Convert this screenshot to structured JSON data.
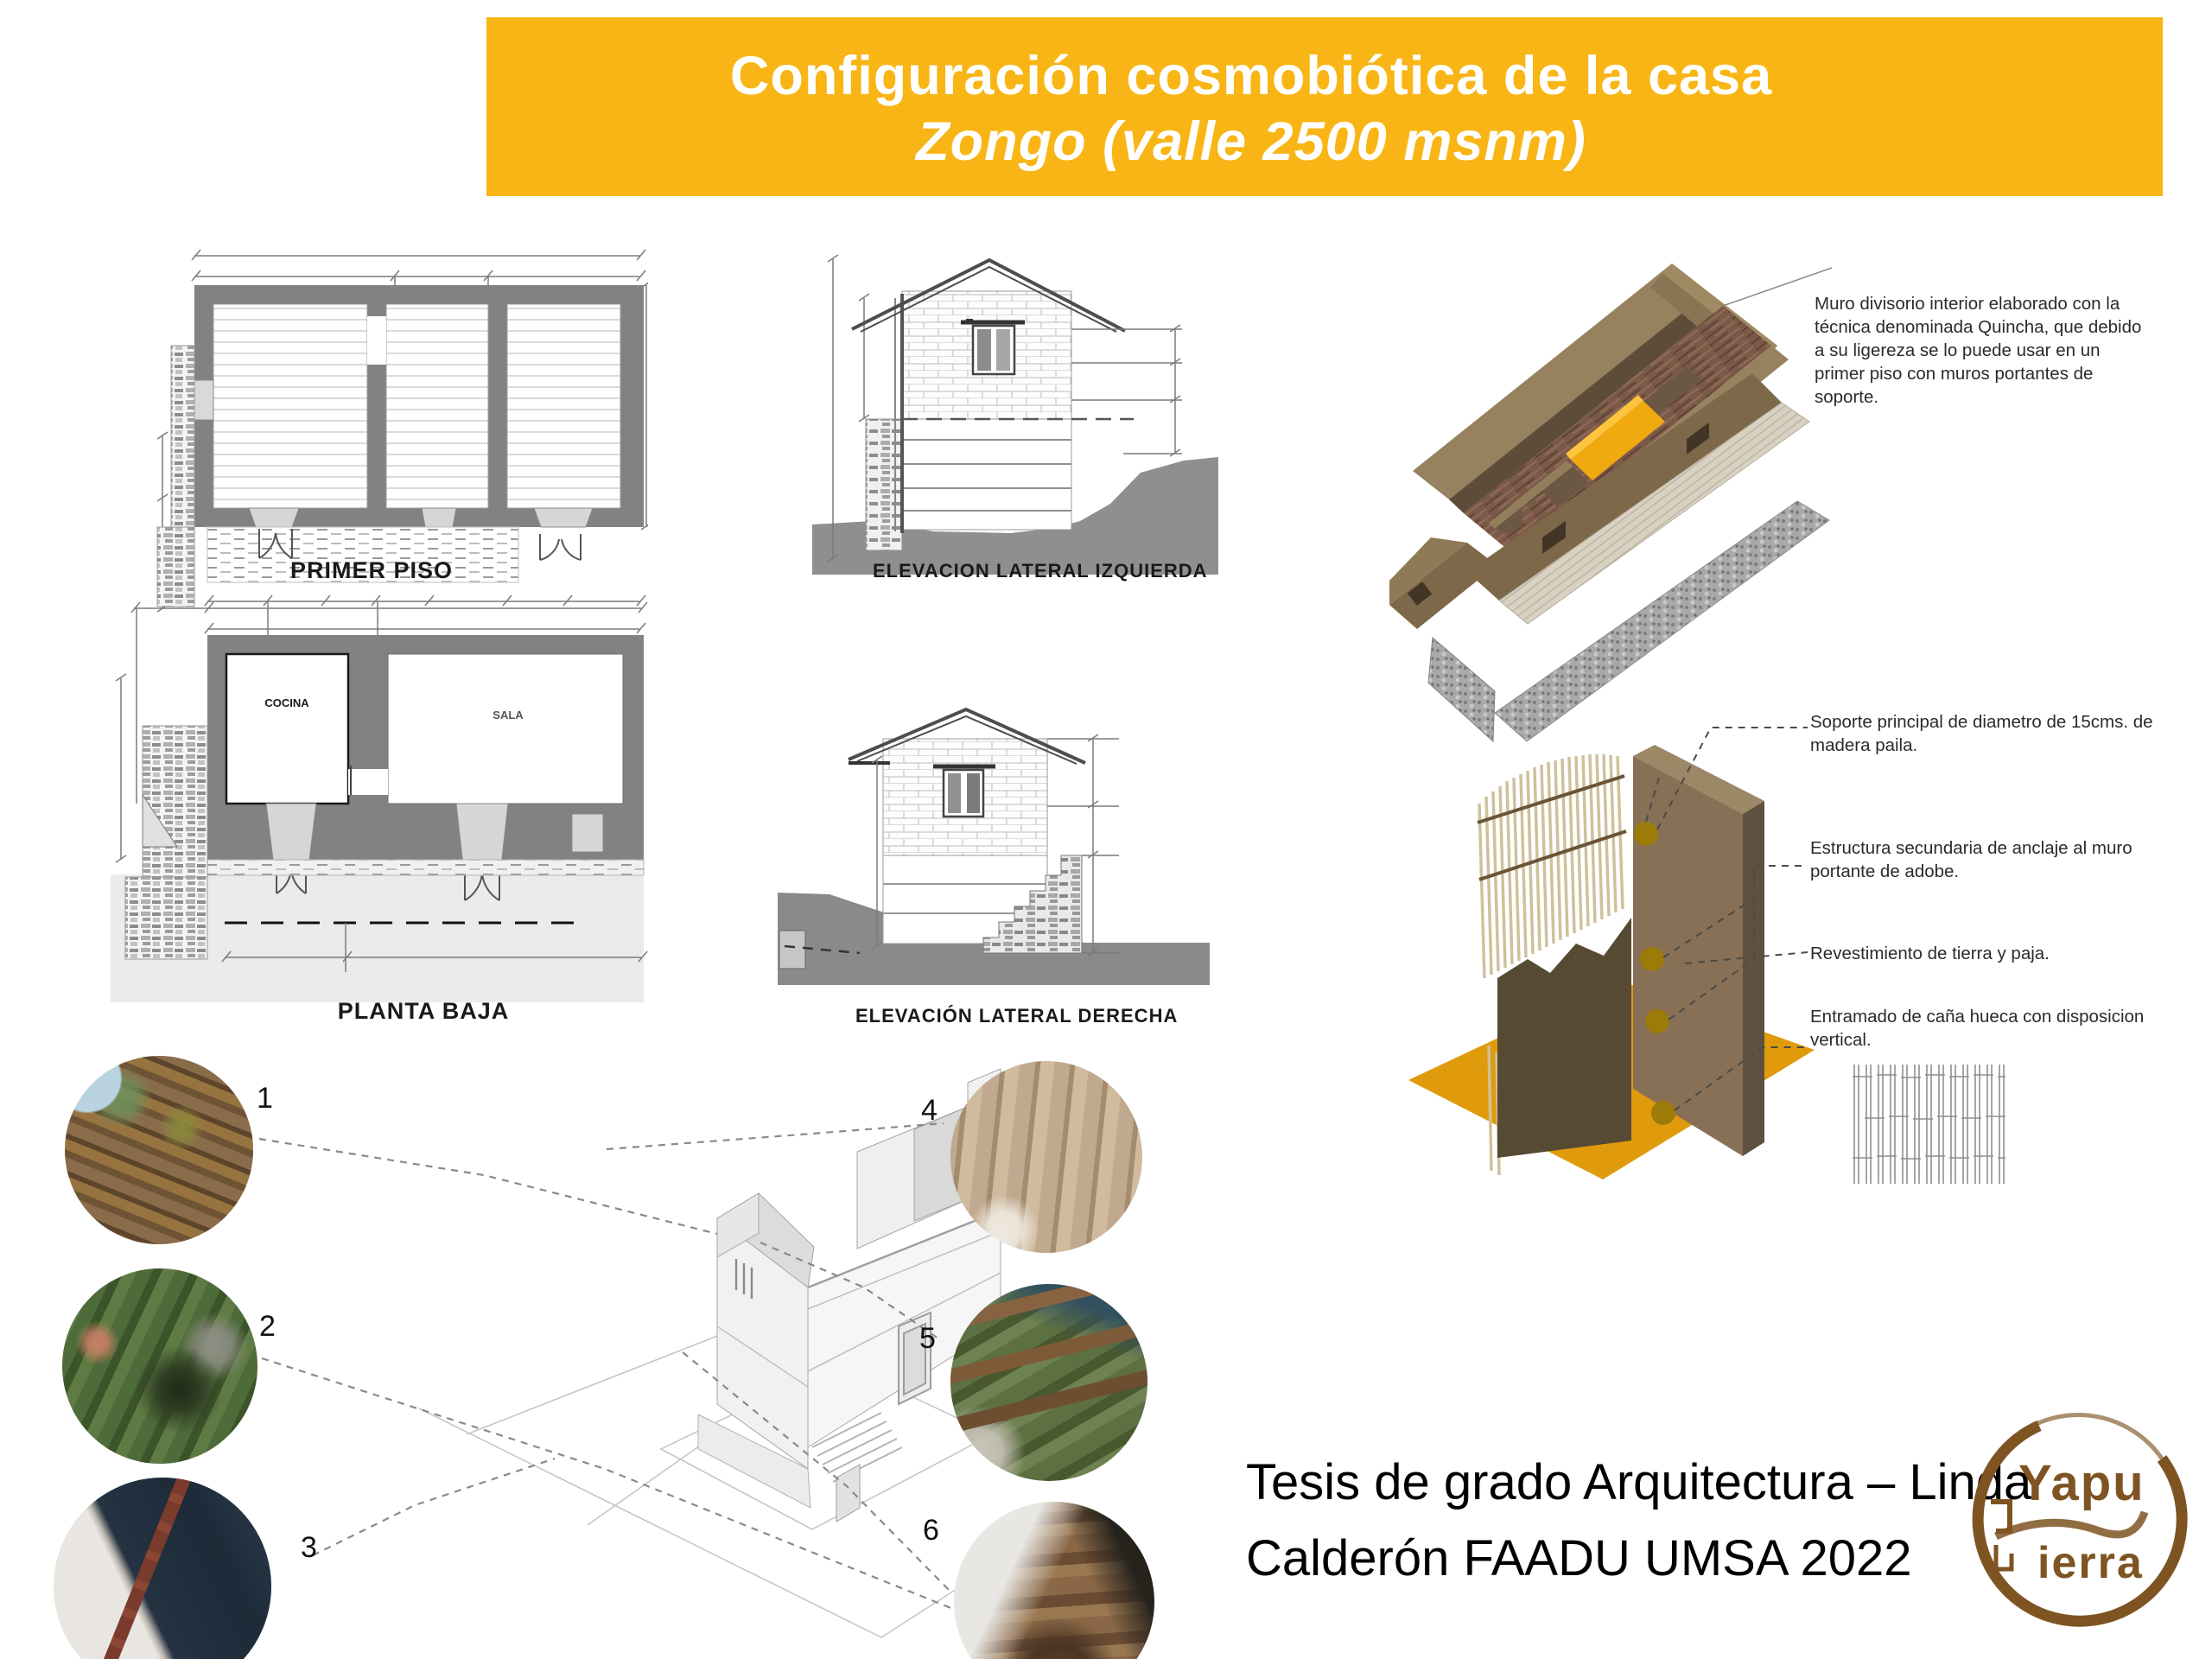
{
  "title": {
    "line1": "Configuración cosmobiótica de la casa",
    "line2": "Zongo (valle 2500 msnm)"
  },
  "drawings": {
    "primer_piso": "PRIMER PISO",
    "planta_baja": "PLANTA BAJA",
    "cocina": "COCINA",
    "sala": "SALA",
    "elev_izq": "ELEVACION LATERAL IZQUIERDA",
    "elev_der": "ELEVACIÓN LATERAL DERECHA"
  },
  "annotations": {
    "quincha": "Muro divisorio interior elaborado con la técnica denominada Quincha, que debido a su ligereza se lo puede usar en un primer piso con muros portantes de soporte.",
    "soporte": "Soporte principal de diametro de 15cms. de madera paila.",
    "estructura": "Estructura secundaria de anclaje al muro portante de adobe.",
    "revestimiento": "Revestimiento de tierra y paja.",
    "entramado": "Entramado de caña hueca con disposicion vertical."
  },
  "photos": [
    {
      "number": "1"
    },
    {
      "number": "2"
    },
    {
      "number": "3"
    },
    {
      "number": "4"
    },
    {
      "number": "5"
    },
    {
      "number": "6"
    }
  ],
  "credit": {
    "line1": "Tesis de grado Arquitectura – Linda",
    "line2": "Calderón FAADU UMSA 2022"
  },
  "logo": {
    "word_top": "Yapu",
    "word_bottom": "ierra"
  },
  "colors": {
    "banner_yellow": "#F8B515",
    "quincha_yellow": "#F0A90F",
    "detail_floor_orange": "#E09B0C",
    "adobe_brown": "#877055",
    "plaster_brown": "#564A33",
    "plan_wall_gray": "#828282",
    "terrain_gray": "#8A8A8A",
    "logo_brown": "#7E5423"
  }
}
